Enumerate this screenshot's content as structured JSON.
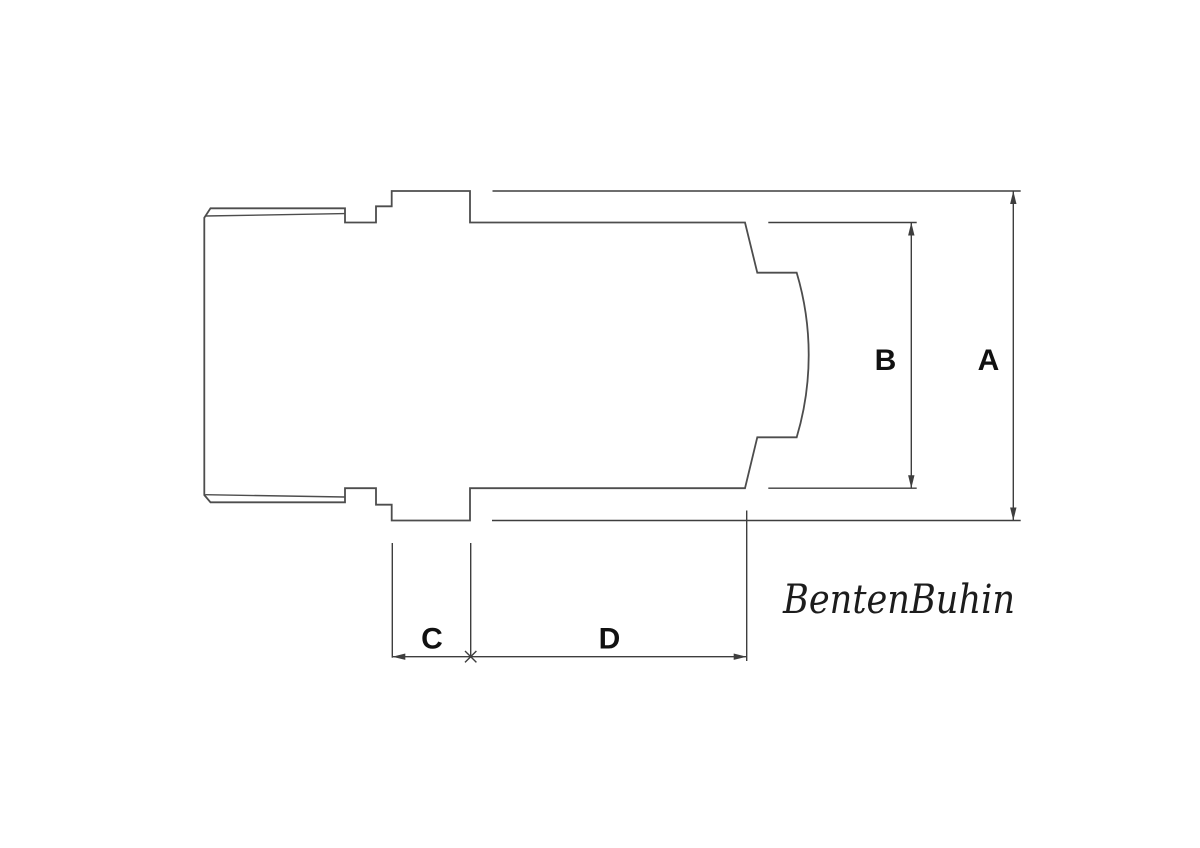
{
  "drawing": {
    "kind": "technical-dimension-diagram",
    "watermark": "BentenBuhin",
    "dimension_labels": {
      "a": "A",
      "b": "B",
      "c": "C",
      "d": "D"
    },
    "colors": {
      "background": "#ffffff",
      "outline": "#4d4d4d",
      "dimension": "#3e3e3e",
      "label": "#111111",
      "watermark": "#1c1c1c"
    }
  }
}
